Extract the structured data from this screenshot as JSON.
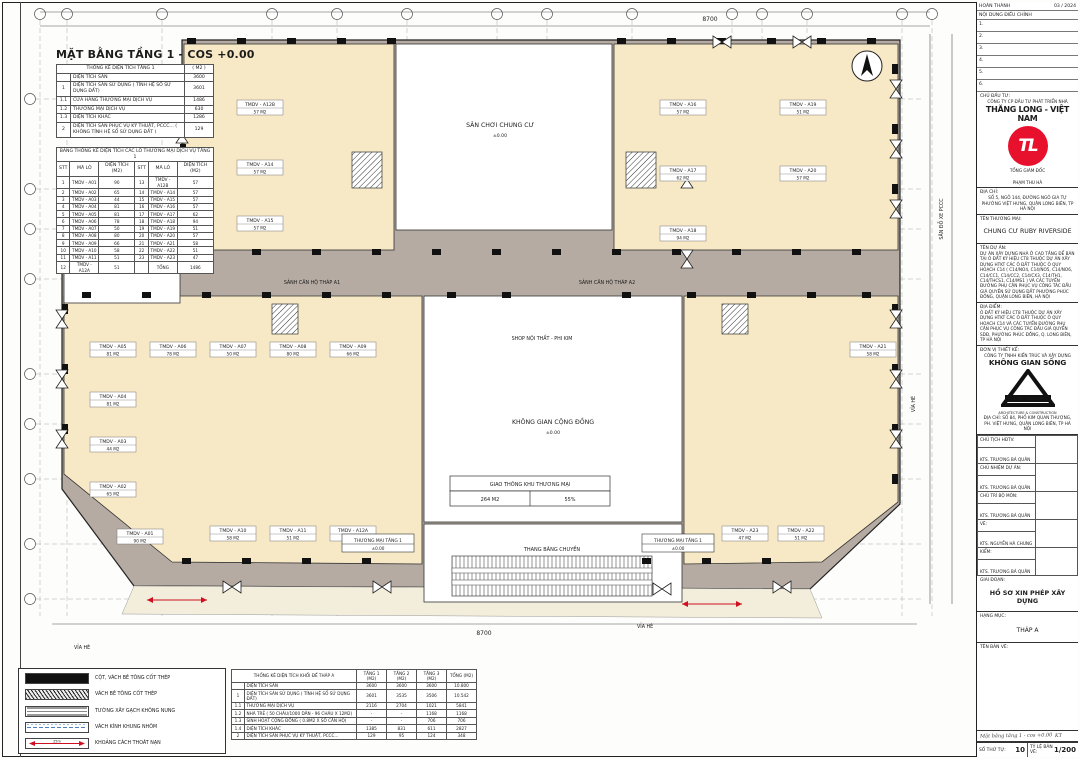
{
  "plan_title": "MẶT BẰNG TẦNG 1 - COS +0.00",
  "area_table": {
    "title": "THỐNG KÊ DIỆN TÍCH TẦNG 1",
    "unit": "( M2 )",
    "rows": [
      {
        "stt": "",
        "name": "DIỆN TÍCH SÀN",
        "val": "3600"
      },
      {
        "stt": "1",
        "name": "DIỆN TÍCH SÀN SỬ DỤNG ( TÍNH HỆ SỐ SỬ DỤNG ĐẤT)",
        "val": "3601"
      },
      {
        "stt": "1.1",
        "name": "CỬA HÀNG THƯƠNG MẠI DỊCH VỤ",
        "val": "1486"
      },
      {
        "stt": "1.2",
        "name": "THƯƠNG MẠI DỊCH VỤ",
        "val": "630"
      },
      {
        "stt": "1.3",
        "name": "DIỆN TÍCH KHÁC",
        "val": "1286"
      },
      {
        "stt": "2",
        "name": "DIỆN TÍCH SÀN PHỤC VỤ KỸ THUẬT, PCCC... ( KHÔNG TÍNH HỆ SỐ SỬ DỤNG ĐẤT )",
        "val": "129"
      }
    ]
  },
  "lots_table": {
    "title": "BẢNG THỐNG KÊ DIỆN TÍCH CÁC LÔ THƯƠNG MẠI DỊCH VỤ TẦNG 1",
    "headers": [
      "STT",
      "MÃ LÔ",
      "DIỆN TÍCH (M2)"
    ],
    "total_label": "TỔNG",
    "total_value": "1486",
    "rows": [
      {
        "stt": "1",
        "code": "TMDV - A01",
        "area": "90"
      },
      {
        "stt": "2",
        "code": "TMDV - A02",
        "area": "65"
      },
      {
        "stt": "3",
        "code": "TMDV - A03",
        "area": "44"
      },
      {
        "stt": "4",
        "code": "TMDV - A04",
        "area": "81"
      },
      {
        "stt": "5",
        "code": "TMDV - A05",
        "area": "81"
      },
      {
        "stt": "6",
        "code": "TMDV - A06",
        "area": "78"
      },
      {
        "stt": "7",
        "code": "TMDV - A07",
        "area": "50"
      },
      {
        "stt": "8",
        "code": "TMDV - A08",
        "area": "80"
      },
      {
        "stt": "9",
        "code": "TMDV - A09",
        "area": "66"
      },
      {
        "stt": "10",
        "code": "TMDV - A10",
        "area": "58"
      },
      {
        "stt": "11",
        "code": "TMDV - A11",
        "area": "51"
      },
      {
        "stt": "12",
        "code": "TMDV - A12A",
        "area": "51"
      },
      {
        "stt": "13",
        "code": "TMDV - A12B",
        "area": "57"
      },
      {
        "stt": "14",
        "code": "TMDV - A14",
        "area": "57"
      },
      {
        "stt": "15",
        "code": "TMDV - A15",
        "area": "57"
      },
      {
        "stt": "16",
        "code": "TMDV - A16",
        "area": "57"
      },
      {
        "stt": "17",
        "code": "TMDV - A17",
        "area": "62"
      },
      {
        "stt": "18",
        "code": "TMDV - A18",
        "area": "94"
      },
      {
        "stt": "19",
        "code": "TMDV - A19",
        "area": "51"
      },
      {
        "stt": "20",
        "code": "TMDV - A20",
        "area": "57"
      },
      {
        "stt": "21",
        "code": "TMDV - A21",
        "area": "58"
      },
      {
        "stt": "22",
        "code": "TMDV - A22",
        "area": "51"
      },
      {
        "stt": "23",
        "code": "TMDV - A23",
        "area": "47"
      }
    ]
  },
  "podium_table": {
    "title": "THỐNG KÊ DIỆN TÍCH KHỐI ĐẾ THÁP A",
    "col_headers": [
      "TẦNG 1 (M2)",
      "TẦNG 2 (M2)",
      "TẦNG 3 (M2)",
      "TỔNG (M2)"
    ],
    "rows": [
      {
        "stt": "",
        "name": "DIỆN TÍCH SÀN",
        "v1": "3600",
        "v2": "3600",
        "v3": "3600",
        "v4": "10.800"
      },
      {
        "stt": "1",
        "name": "DIỆN TÍCH SÀN SỬ DỤNG ( TÍNH HỆ SỐ SỬ DỤNG ĐẤT)",
        "v1": "3601",
        "v2": "3535",
        "v3": "3506",
        "v4": "10.542"
      },
      {
        "stt": "1.1",
        "name": "THƯƠNG MẠI DỊCH VỤ",
        "v1": "2116",
        "v2": "2704",
        "v3": "1021",
        "v4": "5841"
      },
      {
        "stt": "1.2",
        "name": "NHÀ TRẺ ( 50 CHÁU/1000 DÂN - 96 CHÁU X 12M2)",
        "v1": "-",
        "v2": "-",
        "v3": "1168",
        "v4": "1168"
      },
      {
        "stt": "1.3",
        "name": "SINH HOẠT CỘNG ĐỒNG ( 0.8M2 X SỐ CĂN HỘ)",
        "v1": "-",
        "v2": "-",
        "v3": "706",
        "v4": "706"
      },
      {
        "stt": "1.4",
        "name": "DIỆN TÍCH KHÁC",
        "v1": "1385",
        "v2": "831",
        "v3": "611",
        "v4": "2827"
      },
      {
        "stt": "2",
        "name": "DIỆN TÍCH SÀN PHỤC VỤ KỸ THUẬT, PCCC...",
        "v1": "129",
        "v2": "95",
        "v3": "124",
        "v4": "348"
      }
    ]
  },
  "legend": [
    {
      "symbol": "solid-wall",
      "label": "CỘT, VÁCH BÊ TÔNG CỐT THÉP"
    },
    {
      "symbol": "hatch-wall",
      "label": "VÁCH BÊ TÔNG CỐT THÉP"
    },
    {
      "symbol": "brick-wall",
      "label": "TƯỜNG XÂY GẠCH KHÔNG NUNG"
    },
    {
      "symbol": "glass-wall",
      "label": "VÁCH KÍNH KHUNG NHÔM"
    },
    {
      "symbol": "escape-arrow",
      "label": "KHOẢNG CÁCH THOÁT NẠN"
    }
  ],
  "plan_labels": {
    "playground_top": "SÂN CHƠI CHUNG CƯ",
    "playground_left": "SÂN CHƠI CHUNG CƯ",
    "community": "KHÔNG GIAN CỘNG ĐỒNG",
    "lobby_a1": "SẢNH CĂN HỘ THÁP A1",
    "lobby_a2": "SẢNH CĂN HỘ THÁP A2",
    "traffic_title": "GIAO THÔNG KHU THƯƠNG MẠI",
    "traffic_area": "264 M2",
    "traffic_pct": "55%",
    "shop": "SHOP NỘI THẤT - PHI KIM",
    "commercial": "THƯƠNG MẠI TẦNG 1",
    "escalator": "THANG BĂNG CHUYỀN",
    "sidewalk": "VỈA HÈ",
    "fire_lane": "SÂN ĐỖ XE PCCC",
    "elevation": "±0.00",
    "dim_total_top": "8700",
    "dim_total_bottom": "8700"
  },
  "title_block": {
    "completed_label": "HOÀN THÀNH",
    "completed_value": "03 / 2024",
    "revision_label": "NỘI DUNG ĐIỀU CHỈNH",
    "revision_rows": [
      "1.",
      "2.",
      "3.",
      "4.",
      "5.",
      "6."
    ],
    "investor_label": "CHỦ ĐẦU TƯ:",
    "investor_company": "CÔNG TY CP ĐẦU TƯ PHÁT TRIỂN NHÀ",
    "investor_name": "THĂNG LONG - VIỆT NAM",
    "logo_text": "TL",
    "director_title": "TỔNG GIÁM ĐỐC",
    "director_name": "PHẠM THU HÀ",
    "address_label": "ĐỊA CHỈ:",
    "address_line1": "SỐ 5, NGÕ 144, ĐƯỜNG NGÔ GIA TỰ",
    "address_line2": "PHƯỜNG VIỆT HƯNG, QUẬN LONG BIÊN, TP HÀ NỘI",
    "trade_name_label": "TÊN THƯƠNG MẠI:",
    "trade_name": "CHUNG CƯ RUBY RIVERSIDE",
    "project_label": "TÊN DỰ ÁN:",
    "project_text": "DỰ ÁN XÂY DỰNG NHÀ Ở CAO TẦNG ĐỂ BÁN TẠI Ô ĐẤT KÝ HIỆU CT8 THUỘC DỰ ÁN XÂY DỰNG HTKT CÁC Ô ĐẤT THUỘC Ô QUY HOẠCH C14 ( C14/NO4, C14/NO5, C14/NO6, C14/CC1, C14/CC2, C14/CX3, C14/TH1, C14/THCS1, C14/MS1 ) VÀ CÁC TUYẾN ĐƯỜNG PHỤ CẬN PHỤC VỤ CÔNG TÁC ĐẤU GIÁ QUYỀN SỬ DỤNG ĐẤT PHƯỜNG PHÚC ĐỒNG, QUẬN LONG BIÊN, HÀ NỘI",
    "site_label": "ĐỊA ĐIỂM:",
    "site_text": "Ô ĐẤT KÝ HIỆU CT8 THUỘC DỰ ÁN XÂY DỰNG HTKT CÁC Ô ĐẤT THUỘC Ô QUY HOẠCH C14 VÀ CÁC TUYẾN ĐƯỜNG PHỤ CẬN PHỤC VỤ CÔNG TÁC ĐẤU GIÁ QUYỀN SDĐ, PHƯỜNG PHÚC ĐỒNG, Q. LONG BIÊN, TP HÀ NỘI",
    "designer_label": "ĐƠN VỊ THIẾT KẾ:",
    "designer_company": "CÔNG TY TNHH KIẾN TRÚC VÀ XÂY DỰNG",
    "designer_name": "KHÔNG GIAN SỐNG",
    "designer_logo_line1": "Life Space",
    "designer_logo_line2": "ARCHITECTURE & CONSTRUCTION",
    "designer_address": "ĐỊA CHỈ: SỐ 84, PHỐ KIM QUAN THƯỢNG, PH. VIỆT HƯNG, QUẬN LONG BIÊN, TP HÀ NỘI",
    "sign_rows": [
      {
        "label": "CHỦ TỊCH HĐTV:",
        "name": "KTS. TRƯƠNG BÁ QUÂN"
      },
      {
        "label": "CHỦ NHIỆM DỰ ÁN:",
        "name": "KTS. TRƯƠNG BÁ QUÂN"
      },
      {
        "label": "CHỦ TRÌ BỘ MÔN:",
        "name": "KTS. TRƯƠNG BÁ QUÂN"
      },
      {
        "label": "VẼ:",
        "name": "KTS. NGUYỄN HÀ CHUNG"
      },
      {
        "label": "KIỂM:",
        "name": "KTS. TRƯƠNG BÁ QUÂN"
      }
    ],
    "stage_label": "GIAI ĐOẠN:",
    "stage_value": "HỒ SƠ XIN PHÉP XÂY DỰNG",
    "category_label": "HẠNG MỤC:",
    "category_value": "THÁP A",
    "drawing_label": "TÊN BẢN VẼ:",
    "note_left": "Mặt bằng tầng 1 - cos +0.00",
    "note_right": "KT",
    "number_label": "SỐ THỨ TỰ:",
    "number_value": "10",
    "scale_label": "TỶ LỆ BẢN VẼ:",
    "scale_value": "1/200"
  }
}
